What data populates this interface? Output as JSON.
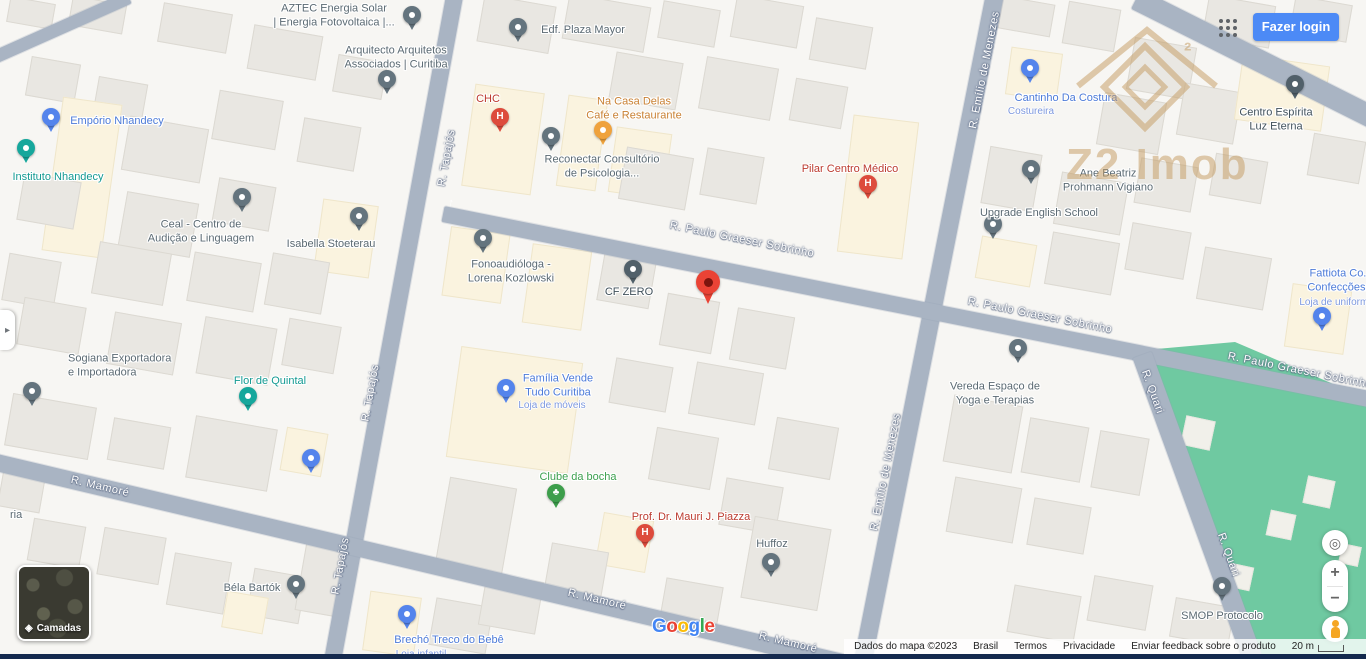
{
  "header": {
    "login_label": "Fazer login",
    "login_color": "#4c8af6"
  },
  "watermark": {
    "brand": "Z2 Imob",
    "color": "#c49a60"
  },
  "icons": {
    "panel_toggle": "▸",
    "zoom_in": "+",
    "zoom_out": "−",
    "locate": "◎",
    "layers": "◈"
  },
  "map": {
    "streets": [
      {
        "name": "R. Tapajós"
      },
      {
        "name": "R. Emílio de Menezes"
      },
      {
        "name": "R. Paulo Graeser Sobrinho"
      },
      {
        "name": "R. Mamoré"
      },
      {
        "name": "R. Quari"
      }
    ],
    "marker_color": "#ea4335",
    "park_color": "#6fc9a1",
    "road_color": "#a9b4c3",
    "pois": [
      {
        "name": "AZTEC Energia Solar\n| Energia Fotovoltaica |..."
      },
      {
        "name": "Arquitecto Arquitetos\nAssociados | Curitiba"
      },
      {
        "name": "Edf. Plaza Mayor"
      },
      {
        "name": "CHC"
      },
      {
        "name": "Na Casa Delas\nCafé e Restaurante"
      },
      {
        "name": "Reconectar Consultório\nde Psicologia..."
      },
      {
        "name": "Pilar Centro Médico"
      },
      {
        "name": "Cantinho Da Costura",
        "sub": "Costureira"
      },
      {
        "name": "Centro Espírita\nLuz Eterna"
      },
      {
        "name": "Ane Beatriz\nProhmann Vigiano"
      },
      {
        "name": "Upgrade English School"
      },
      {
        "name": "Empório Nhandecy"
      },
      {
        "name": "Instituto Nhandecy"
      },
      {
        "name": "Ceal - Centro de\nAudição e Linguagem"
      },
      {
        "name": "Isabella Stoeterau"
      },
      {
        "name": "Fonoaudióloga -\nLorena Kozlowski"
      },
      {
        "name": "CF ZERO"
      },
      {
        "name": "Fattiota Co...\nConfecções...",
        "sub": "Loja de uniform..."
      },
      {
        "name": "Sogiana Exportadora\ne Importadora"
      },
      {
        "name": "Flor de Quintal"
      },
      {
        "name": "Família Vende\nTudo Curitiba",
        "sub": "Loja de móveis"
      },
      {
        "name": ""
      },
      {
        "name": "Clube da bocha"
      },
      {
        "name": "Prof. Dr. Mauri J. Piazza"
      },
      {
        "name": "Huffoz"
      },
      {
        "name": "Vereda Espaço de\nYoga e Terapias"
      },
      {
        "name": "Béla Bartók"
      },
      {
        "name": "Brechó Treco do Bebê",
        "sub": "Loja infantil"
      },
      {
        "name": "SMOP Protocolo"
      },
      {
        "name": "ria"
      }
    ]
  },
  "layers_card": {
    "label": "Camadas"
  },
  "google": {
    "letters": [
      "G",
      "o",
      "o",
      "g",
      "l",
      "e"
    ]
  },
  "attribution": {
    "map_data": "Dados do mapa ©2023",
    "region": "Brasil",
    "terms": "Termos",
    "privacy": "Privacidade",
    "feedback": "Enviar feedback sobre o produto",
    "scale": "20 m"
  }
}
